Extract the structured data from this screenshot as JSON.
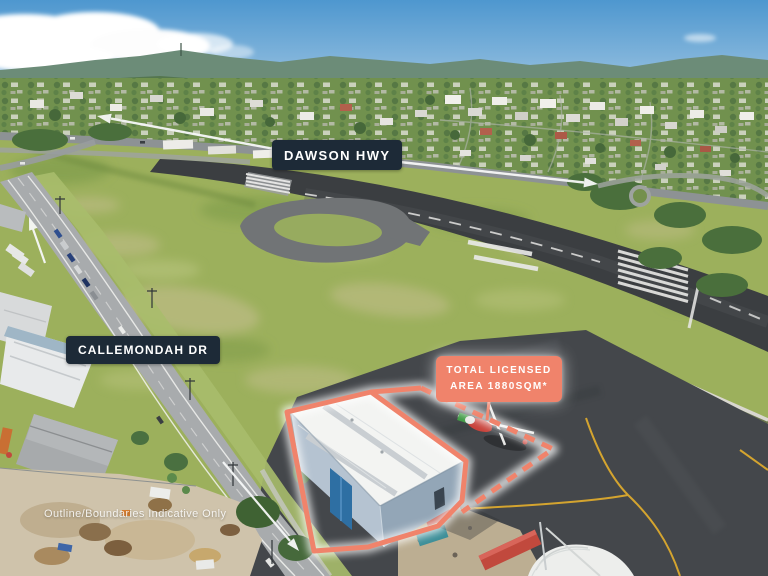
{
  "annotations": {
    "highway_label": "DAWSON HWY",
    "street_label": "CALLEMONDAH DR",
    "licensed_area": {
      "line1": "TOTAL LICENSED",
      "line2": "AREA 1880SQM*"
    },
    "disclaimer": "Outline/Boundaries Indicative Only"
  },
  "colors": {
    "label_bg": "#1D2A37",
    "label_text": "#FFFFFF",
    "accent": "#F0836B",
    "accent_text": "#FFFFFF"
  },
  "icons": {
    "highway_arrow_left": "arrow-up-left",
    "highway_arrow_right": "arrow-right",
    "road_arrow_top": "arrow-up-left",
    "road_arrow_bottom": "arrow-down-right"
  }
}
